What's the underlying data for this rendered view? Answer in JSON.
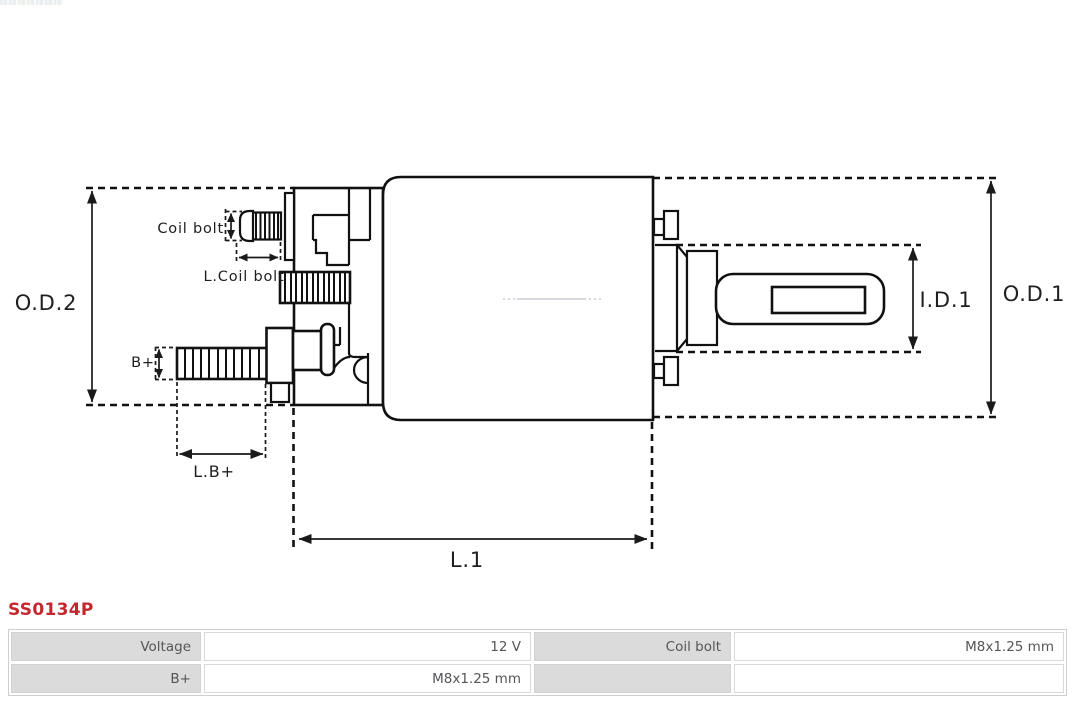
{
  "part_number": {
    "text": "SS0134P",
    "color": "#c4272e"
  },
  "diagram": {
    "stroke_color": "#111111",
    "labels": {
      "od2": "O.D.2",
      "od1": "O.D.1",
      "id1": "I.D.1",
      "l1": "L.1",
      "coil_bolt": "Coil bolt",
      "l_coil_bolt": "L.Coil bolt",
      "b_plus": "B+",
      "l_b_plus": "L.B+"
    }
  },
  "spec_table": {
    "label_bg": "#dbdbdb",
    "value_bg": "#ffffff",
    "border_color": "#cfcfcf",
    "text_color": "#56565a",
    "rows": [
      {
        "cells": [
          "Voltage",
          "12 V",
          "Coil bolt",
          "M8x1.25 mm"
        ]
      },
      {
        "cells": [
          "B+",
          "M8x1.25 mm",
          "",
          ""
        ]
      }
    ]
  }
}
